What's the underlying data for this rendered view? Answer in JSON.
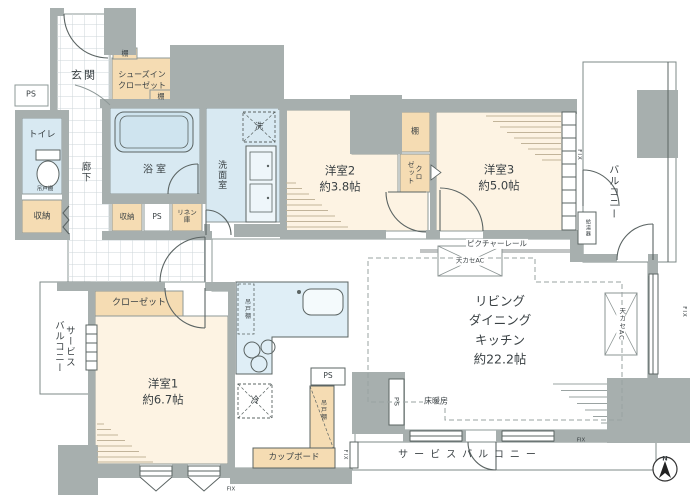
{
  "palette": {
    "wall": "#a7afae",
    "line": "#4e5857",
    "room_cream": "#fdf3e3",
    "wet_blue": "#d8e9f2",
    "storage_tan": "#f5dcb3",
    "tub_blue": "#cfe4ef",
    "counter_blue": "#dfeef6"
  },
  "rooms": {
    "ldk": {
      "name": "リビング\nダイニング\nキッチン",
      "size": "約22.2帖"
    },
    "bedroom1": {
      "name": "洋室1",
      "size": "約6.7帖"
    },
    "bedroom2": {
      "name": "洋室2",
      "size": "約3.8帖"
    },
    "bedroom3": {
      "name": "洋室3",
      "size": "約5.0帖"
    },
    "entrance": {
      "name": "玄関"
    },
    "hallway": {
      "name": "廊下"
    },
    "toilet": {
      "name": "トイレ"
    },
    "bathroom": {
      "name": "浴室"
    },
    "washroom": {
      "name": "洗面室"
    },
    "balcony": {
      "name": "バルコニー"
    },
    "service_balcony_left": {
      "name": "サービス\nバルコニー"
    },
    "service_balcony_bottom": {
      "name": "サービスバルコニー"
    }
  },
  "storage": {
    "shoes_closet": "シューズイン\nクローゼット",
    "closet_b1": "クローゼット",
    "closet_b3": "クロ\nゼット",
    "shelf": "棚",
    "storage_label": "収納",
    "linen": "リネン\n庫",
    "hanging_cupboard": "吊戸棚",
    "cupboard": "カップボード"
  },
  "equipment": {
    "ps": "PS",
    "washer": "洗",
    "fridge": "冷",
    "water_heater": "給湯器",
    "ceiling_ac": "天カセAC",
    "floor_heating": "床暖房",
    "picture_rail": "ピクチャーレール",
    "fix": "FIX",
    "north": "N"
  }
}
